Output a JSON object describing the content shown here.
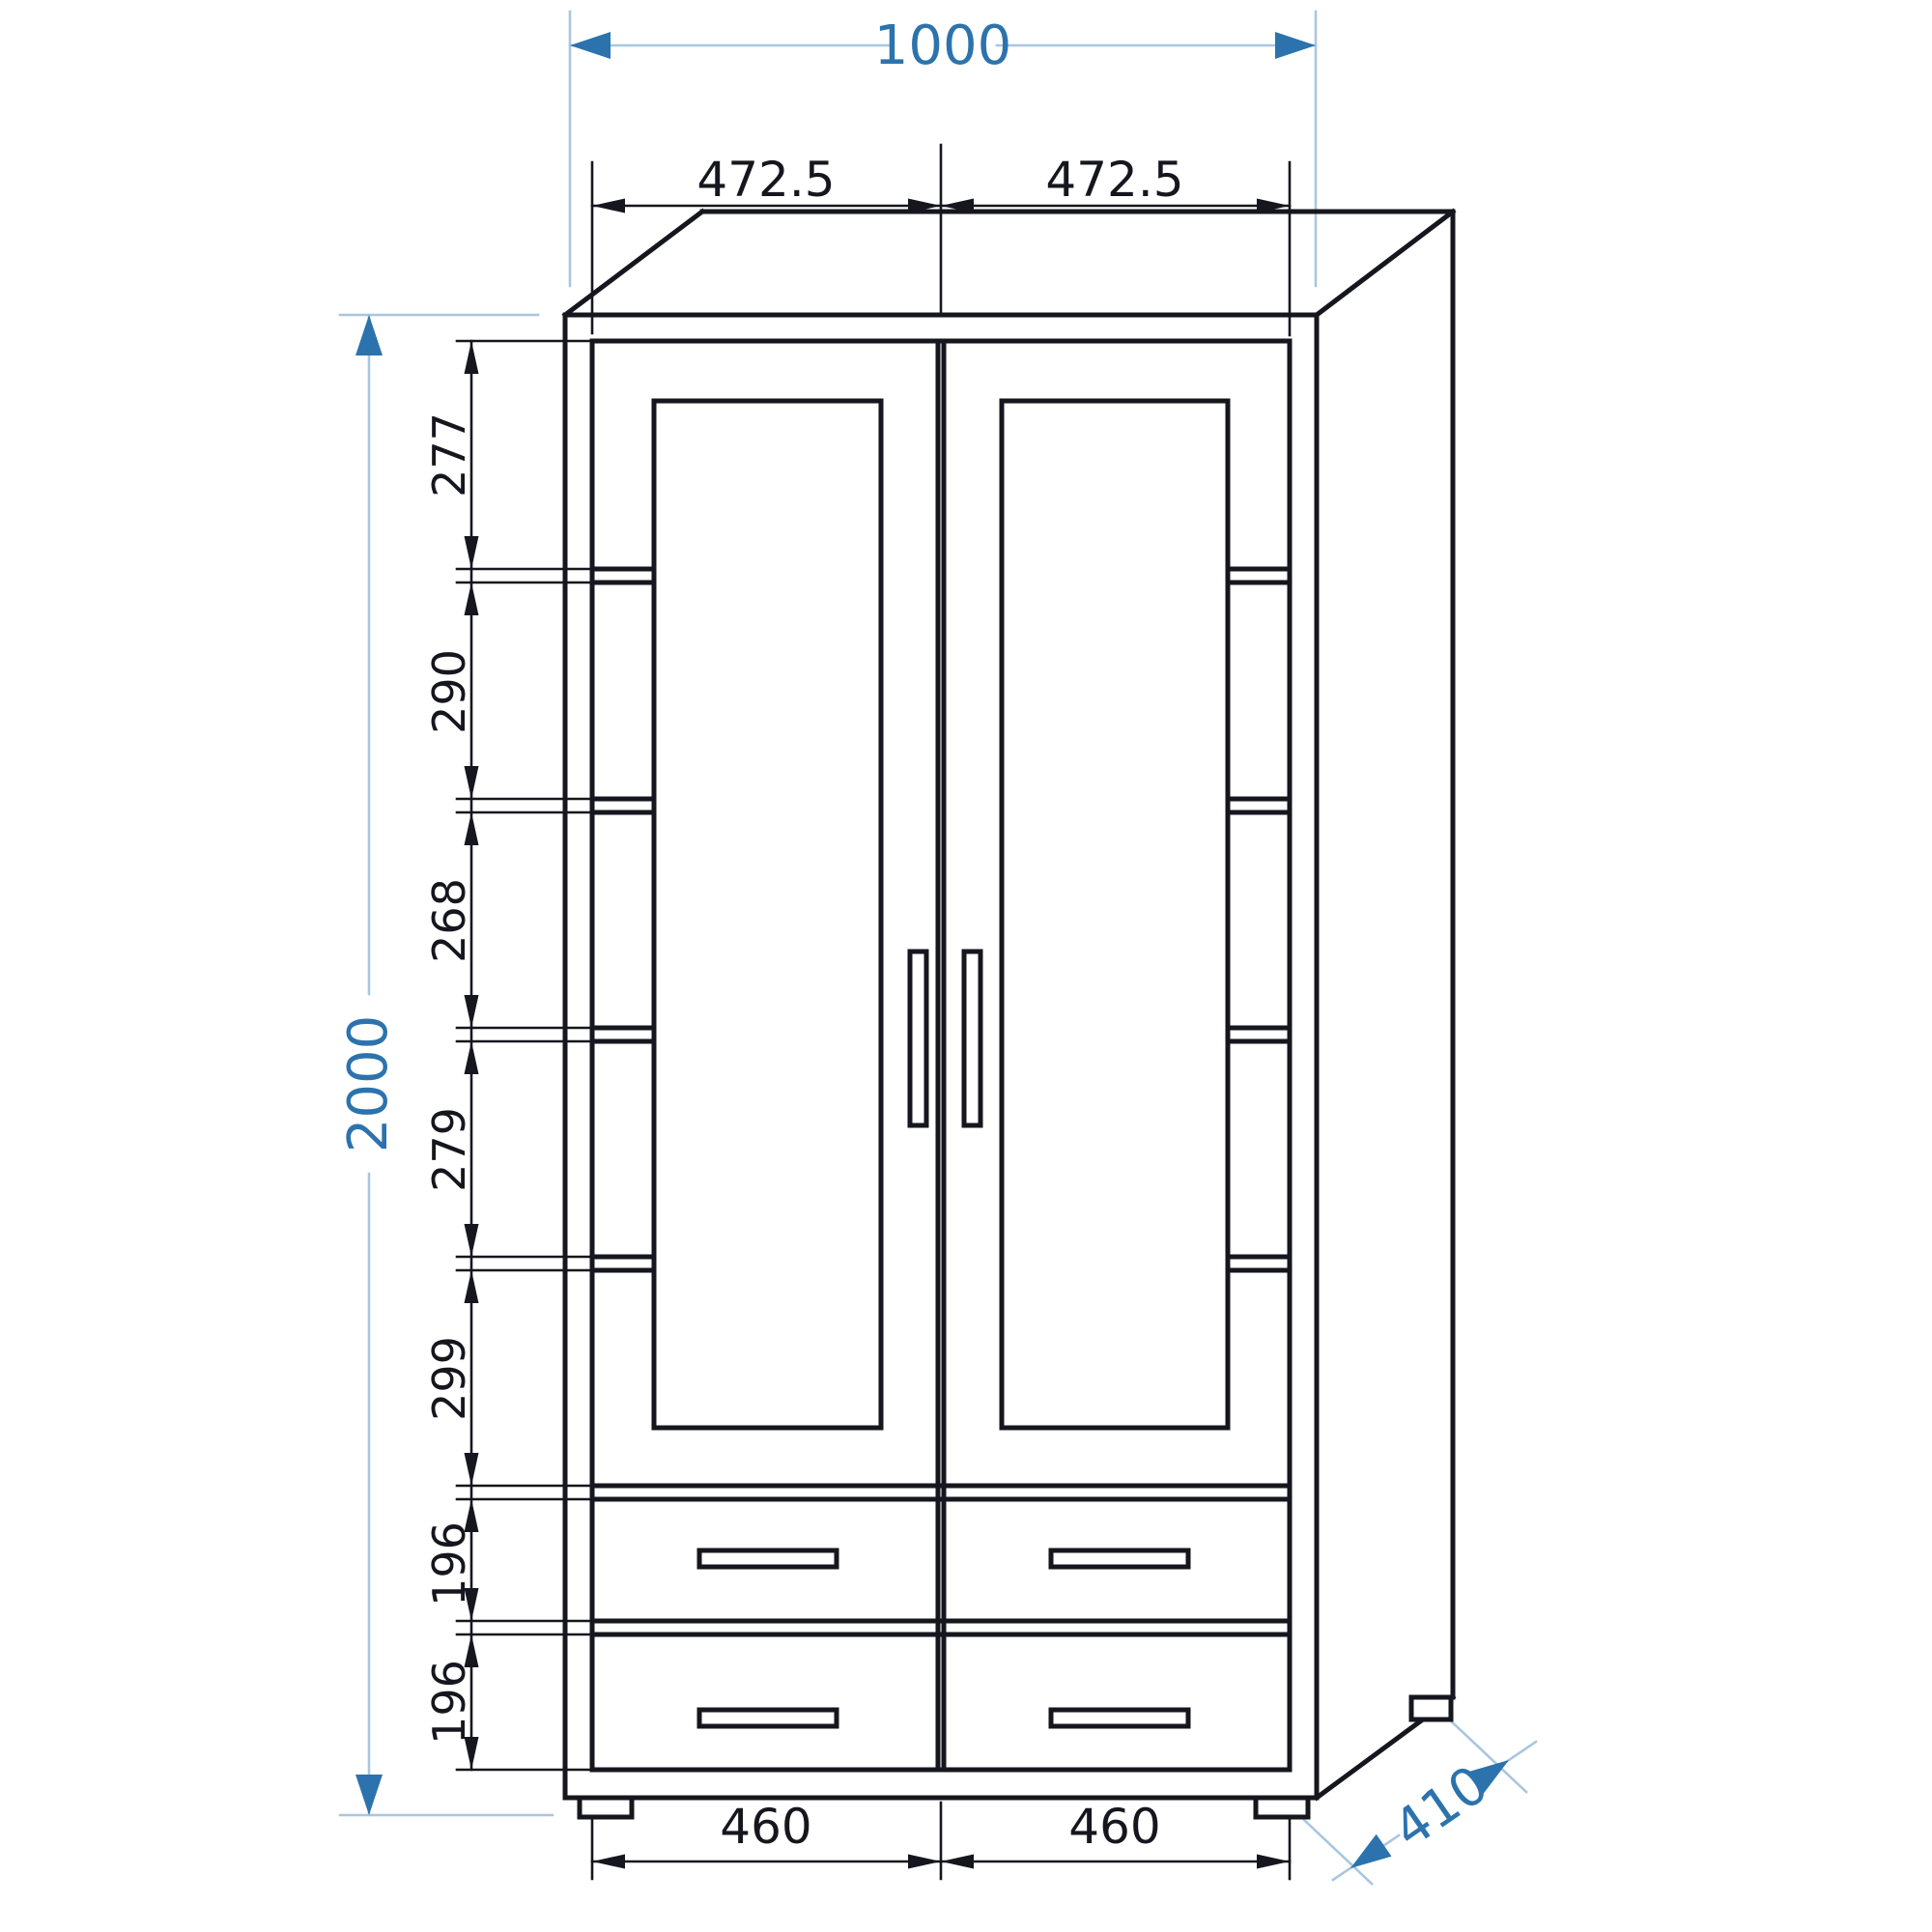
{
  "drawing": {
    "type": "furniture-technical-drawing",
    "object": "two-door glass display cabinet with shelves and four drawers, oblique projection",
    "units": "mm",
    "colors": {
      "line": "#16161e",
      "dim_blue": "#2c73ad",
      "dim_blue_light": "#a9c6e0",
      "background": "#ffffff"
    },
    "dims": {
      "total_width": {
        "label": "1000",
        "value": 1000
      },
      "total_height": {
        "label": "2000",
        "value": 2000
      },
      "depth": {
        "label": "410",
        "value": 410
      },
      "door_widths": [
        {
          "label": "472.5",
          "value": 472.5
        },
        {
          "label": "472.5",
          "value": 472.5
        }
      ],
      "drawer_widths": [
        {
          "label": "460",
          "value": 460
        },
        {
          "label": "460",
          "value": 460
        }
      ],
      "height_chain": [
        {
          "label": "277",
          "value": 277
        },
        {
          "label": "290",
          "value": 290
        },
        {
          "label": "268",
          "value": 268
        },
        {
          "label": "279",
          "value": 279
        },
        {
          "label": "299",
          "value": 299
        },
        {
          "label": "196",
          "value": 196
        },
        {
          "label": "196",
          "value": 196
        }
      ]
    }
  }
}
